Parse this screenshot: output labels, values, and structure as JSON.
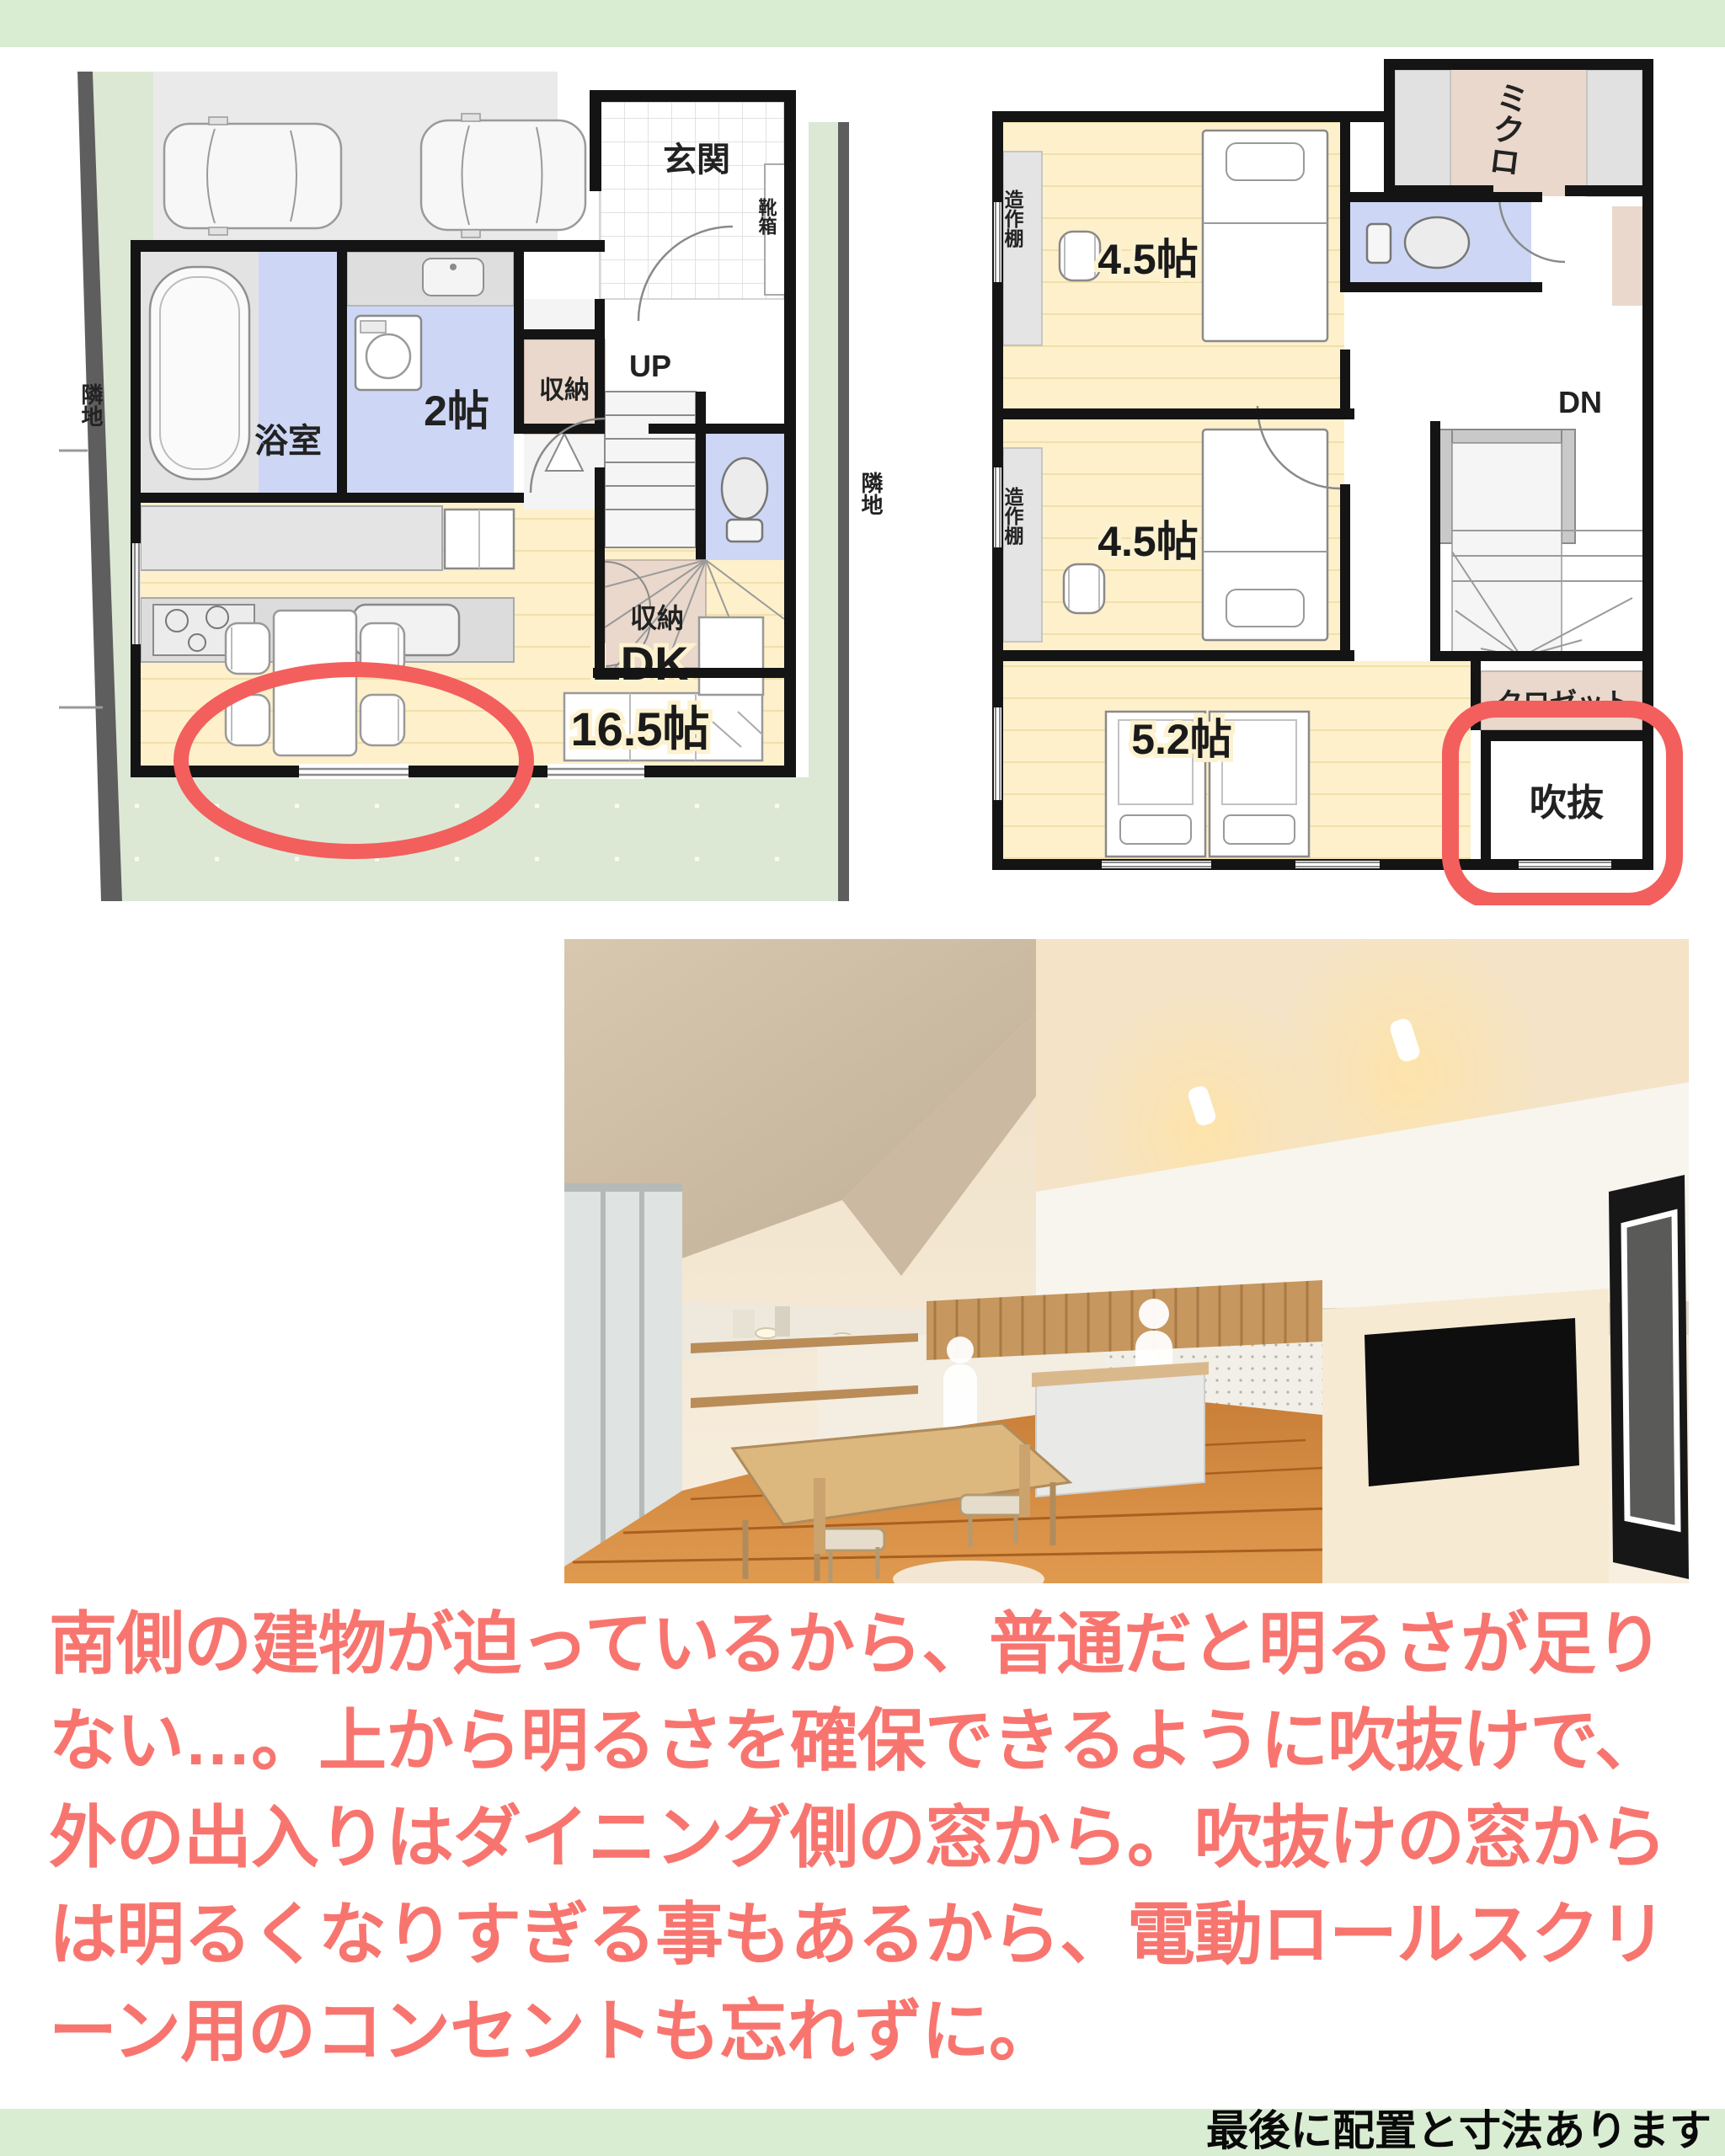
{
  "colors": {
    "bar_green": "#d9edd3",
    "site_green": "#dce8d4",
    "floor_cream": "#fdf0cb",
    "room_blue": "#cdd7f5",
    "closet_pink": "#e9d8cb",
    "annotation_red": "#f25f5d",
    "note_pink": "#f8756f",
    "wall_black": "#141414"
  },
  "plan_1f": {
    "site_label": "隣地",
    "entrance": "玄関",
    "shoe_box": "靴箱",
    "bathroom": "浴室",
    "laundry_room": "2帖",
    "storage_upper": "収納",
    "stairs": "UP",
    "storage_under_stairs": "収納",
    "ldk_name": "LDK",
    "ldk_size": "16.5帖"
  },
  "plan_2f": {
    "site_label": "隣地",
    "family_closet": "ミクロ",
    "built_in_shelf_upper": "造作棚",
    "built_in_shelf_lower": "造作棚",
    "bedroom_upper_size": "4.5帖",
    "bedroom_middle_size": "4.5帖",
    "bedroom_lower_size": "5.2帖",
    "stairs": "DN",
    "closet": "クロゼット",
    "void": "吹抜"
  },
  "note": {
    "lines": [
      "南側の建物が迫っているから、普通だと明るさが足り",
      "ない…。上から明るさを確保できるように吹抜けで、",
      "外の出入りはダイニング側の窓から。吹抜けの窓から",
      "は明るくなりすぎる事もあるから、電動ロールスクリ",
      "ーン用のコンセントも忘れずに。"
    ]
  },
  "footer": {
    "text": "最後に配置と寸法あります"
  }
}
